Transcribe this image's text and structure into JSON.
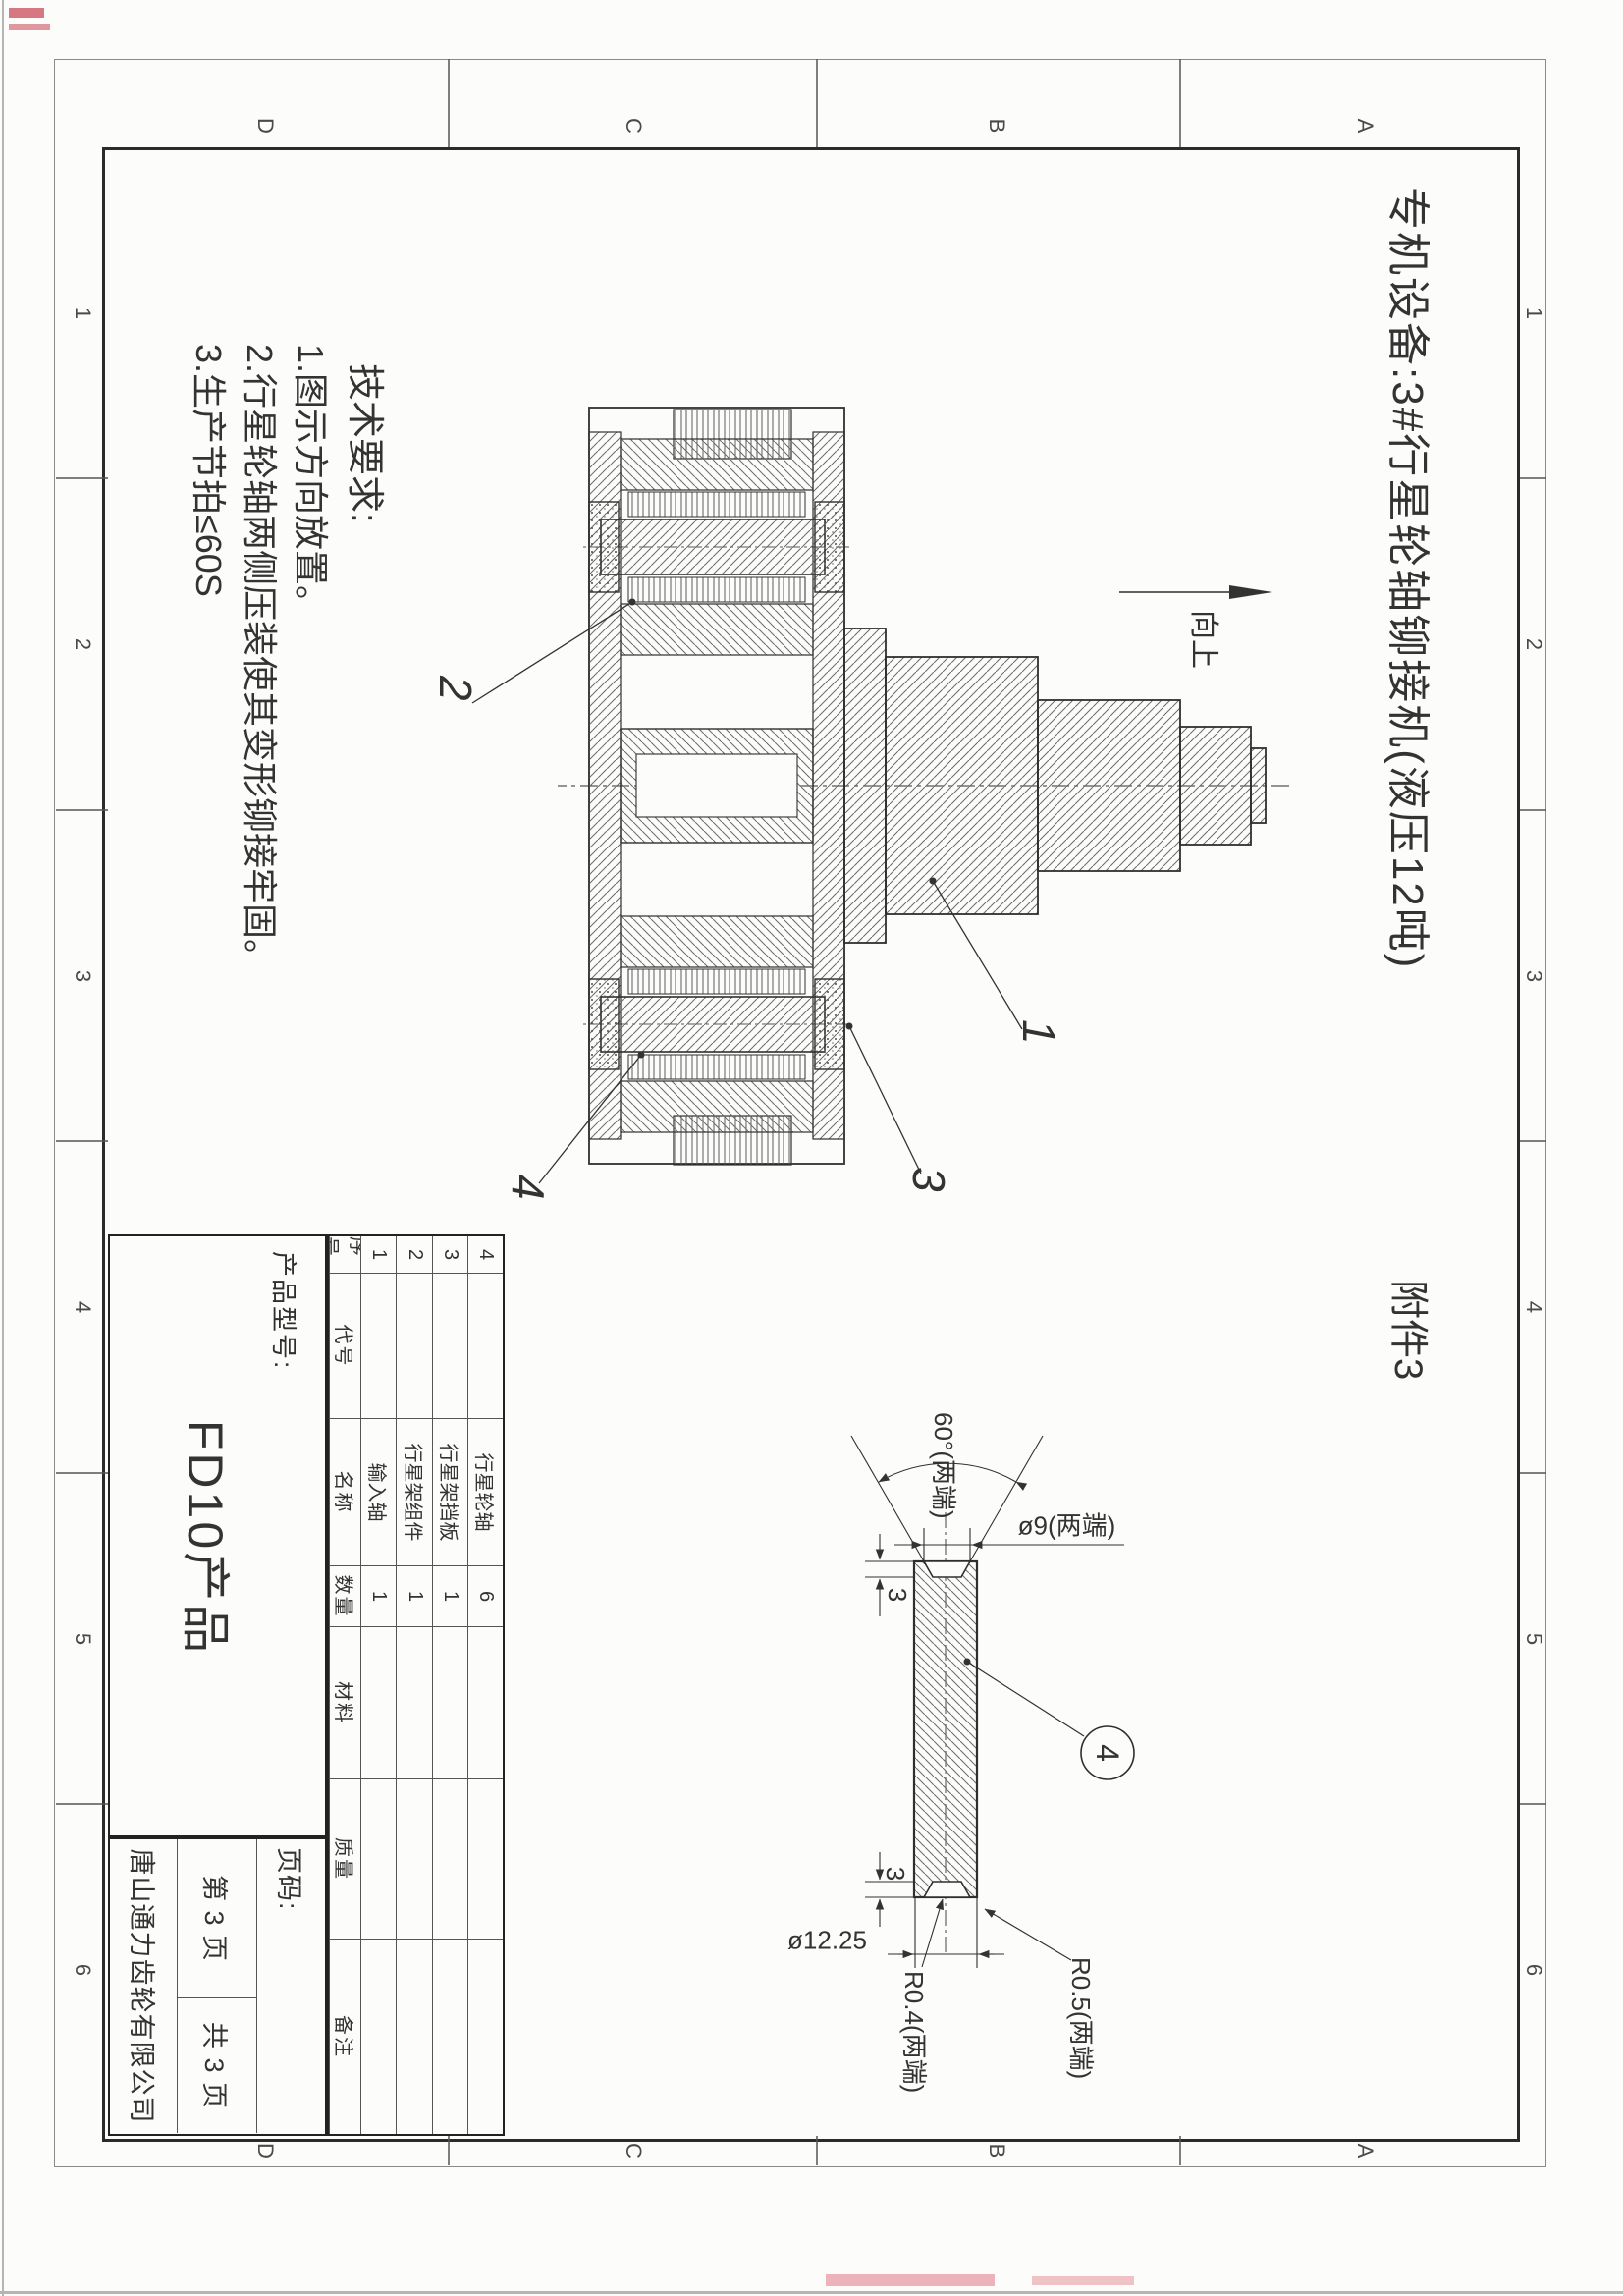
{
  "title": "专机设备:3#行星轮轴铆接机(液压12吨)",
  "attachment": "附件3",
  "up_label": "向上",
  "tech": {
    "heading": "技术要求:",
    "item1": "1.图示方向放置。",
    "item2": "2.行星轮轴两侧压装使其变形铆接牢固。",
    "item3": "3.生产节拍≤60S"
  },
  "callouts": {
    "c1": "1",
    "c2": "2",
    "c3": "3",
    "c4": "4"
  },
  "detail": {
    "angle": "60°(两端)",
    "mouth_dia": "ø9(两端)",
    "depth_left": "3",
    "depth_right": "3",
    "pin_dia": "ø12.25",
    "radius_outer": "R0.5(两端)",
    "radius_inner": "R0.4(两端)",
    "balloon": "4"
  },
  "bom": {
    "headers": [
      "序号",
      "代号",
      "名称",
      "数量",
      "材料",
      "质量",
      "备注"
    ],
    "rows": [
      {
        "seq": "4",
        "code": "",
        "name": "行星轮轴",
        "qty": "6",
        "mat": "",
        "wt": "",
        "note": ""
      },
      {
        "seq": "3",
        "code": "",
        "name": "行星架挡板",
        "qty": "1",
        "mat": "",
        "wt": "",
        "note": ""
      },
      {
        "seq": "2",
        "code": "",
        "name": "行星架组件",
        "qty": "1",
        "mat": "",
        "wt": "",
        "note": ""
      },
      {
        "seq": "1",
        "code": "",
        "name": "输入轴",
        "qty": "1",
        "mat": "",
        "wt": "",
        "note": ""
      }
    ]
  },
  "titleblock": {
    "model_label": "产品型号:",
    "model": "FD10产品",
    "page_label": "页码:",
    "page_no": "第 3 页",
    "page_total": "共 3 页",
    "company": "唐山通力齿轮有限公司"
  },
  "zones": {
    "cols": [
      "1",
      "2",
      "3",
      "4",
      "5",
      "6"
    ],
    "rows": [
      "A",
      "B",
      "C",
      "D"
    ]
  }
}
